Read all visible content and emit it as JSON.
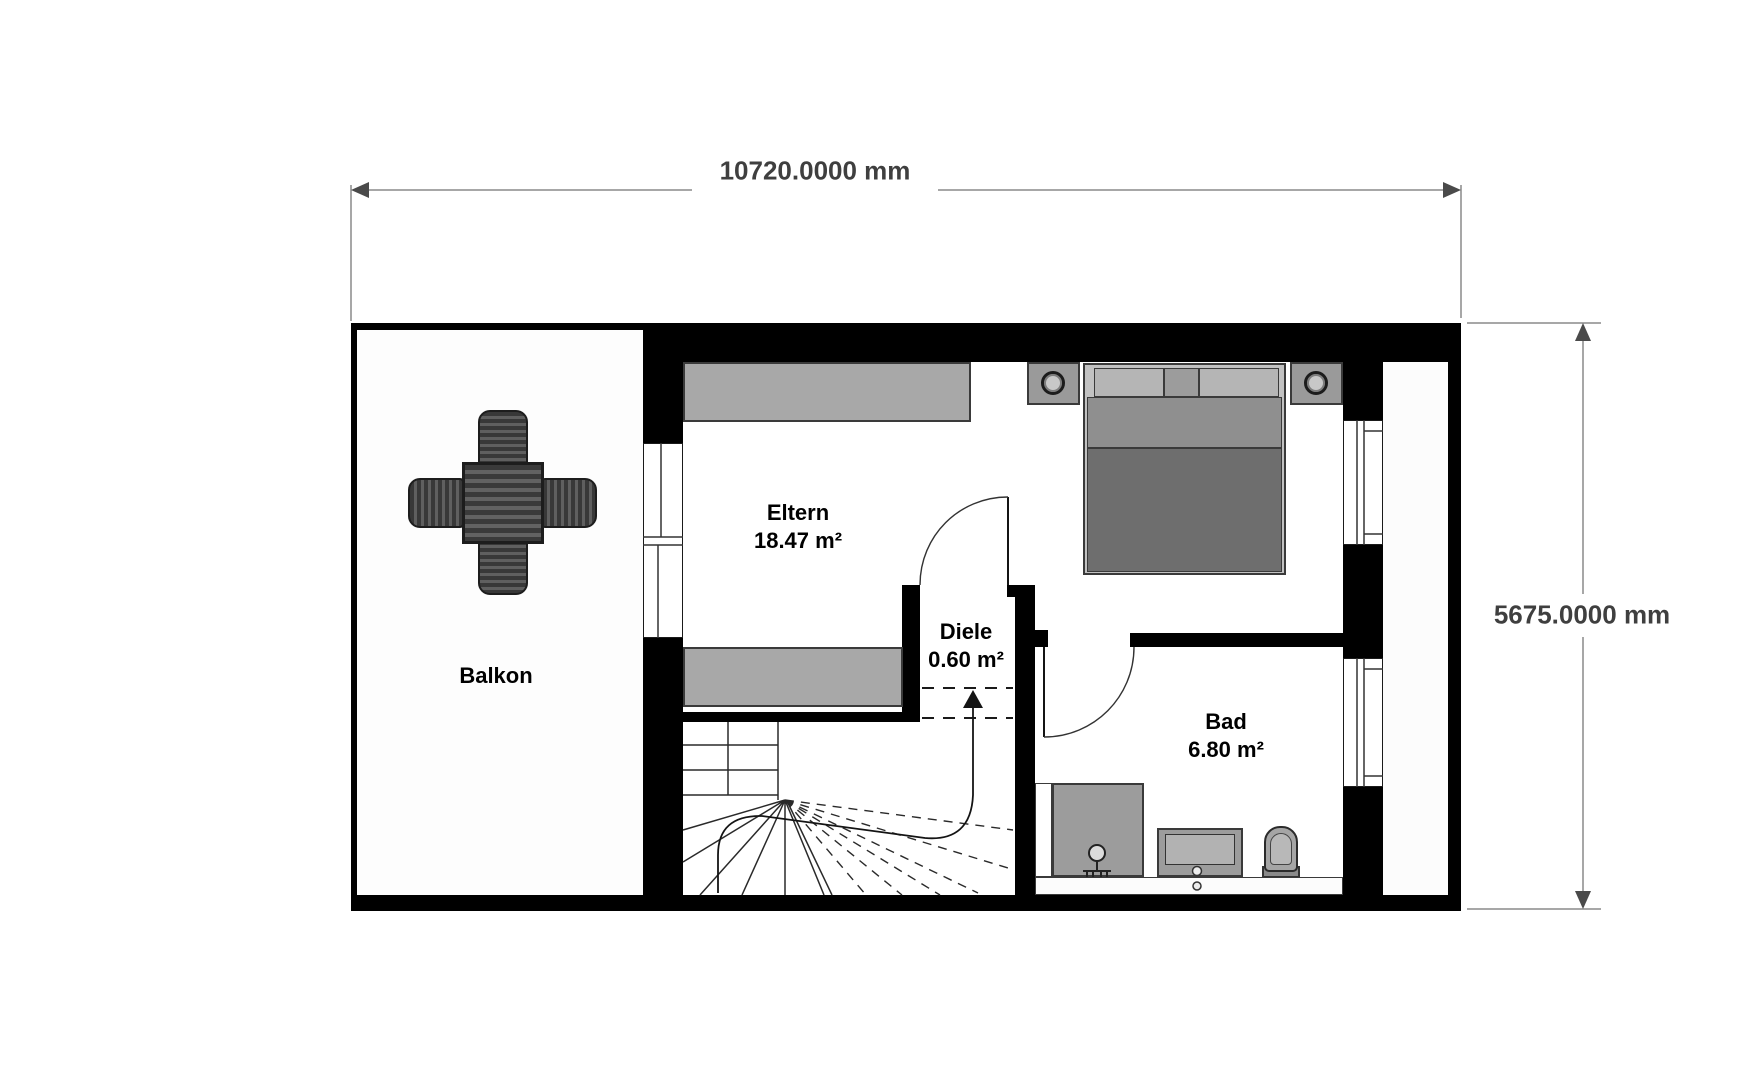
{
  "dimensions": {
    "width": "10720.0000 mm",
    "height": "5675.0000 mm"
  },
  "rooms": {
    "balkon": {
      "name": "Balkon"
    },
    "eltern": {
      "name": "Eltern",
      "area": "18.47 m²"
    },
    "diele": {
      "name": "Diele",
      "area": "0.60 m²"
    },
    "bad": {
      "name": "Bad",
      "area": "6.80 m²"
    }
  },
  "furniture": {
    "table_set": "patio-table-with-four-chairs",
    "bed": "double-bed",
    "nightstands": "2",
    "wardrobes": "2",
    "shower": "shower",
    "vanity": "sink-vanity",
    "toilet": "toilet",
    "stairs": "winder-staircase-with-walk-line"
  },
  "colors": {
    "wall": "#000000",
    "furniture_gray": "#a8a8a8",
    "bed_dark": "#6e6e6e",
    "dimension_line": "#8a8a8a",
    "label_text": "#000000"
  }
}
